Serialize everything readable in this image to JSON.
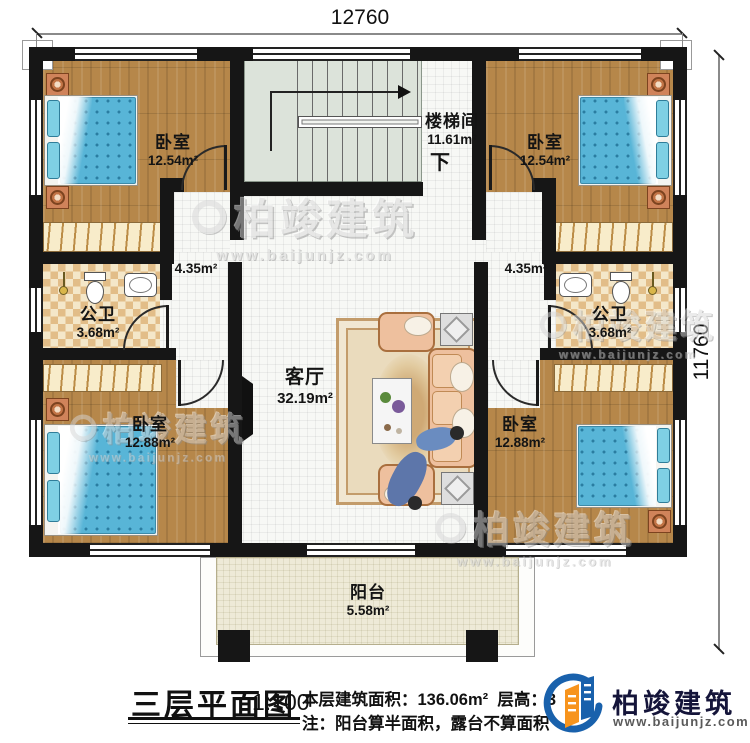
{
  "dimensions": {
    "top": "12760",
    "right": "11760"
  },
  "rooms": {
    "bedroom_tl": {
      "name": "卧室",
      "area": "12.54m²"
    },
    "bedroom_tr": {
      "name": "卧室",
      "area": "12.54m²"
    },
    "stairwell": {
      "name": "楼梯间",
      "area": "11.61m²",
      "direction": "下"
    },
    "corridor_left": {
      "area": "4.35m²"
    },
    "corridor_right": {
      "area": "4.35m²"
    },
    "bath_left": {
      "name": "公卫",
      "area": "3.68m²"
    },
    "bath_right": {
      "name": "公卫",
      "area": "3.68m²"
    },
    "living": {
      "name": "客厅",
      "area": "32.19m²"
    },
    "bedroom_bl": {
      "name": "卧室",
      "area": "12.88m²"
    },
    "bedroom_br": {
      "name": "卧室",
      "area": "12.88m²"
    },
    "balcony": {
      "name": "阳台",
      "area": "5.58m²"
    }
  },
  "titleblock": {
    "title": "三层平面图",
    "scale": "1:100",
    "area_line": "本层建筑面积：136.06m²",
    "floor_height": "层高：3",
    "note": "注：阳台算半面积，露台不算面积"
  },
  "brand": {
    "name": "柏竣建筑",
    "url": "www.baijunjz.com"
  },
  "watermark": {
    "name": "柏竣建筑",
    "url": "www.baijunjz.com"
  },
  "colors": {
    "wall": "#161616",
    "wood": "#b6874a",
    "bed_blue": "#58b5d7",
    "brand_blue": "#1961ac",
    "brand_orange": "#f7941d"
  }
}
